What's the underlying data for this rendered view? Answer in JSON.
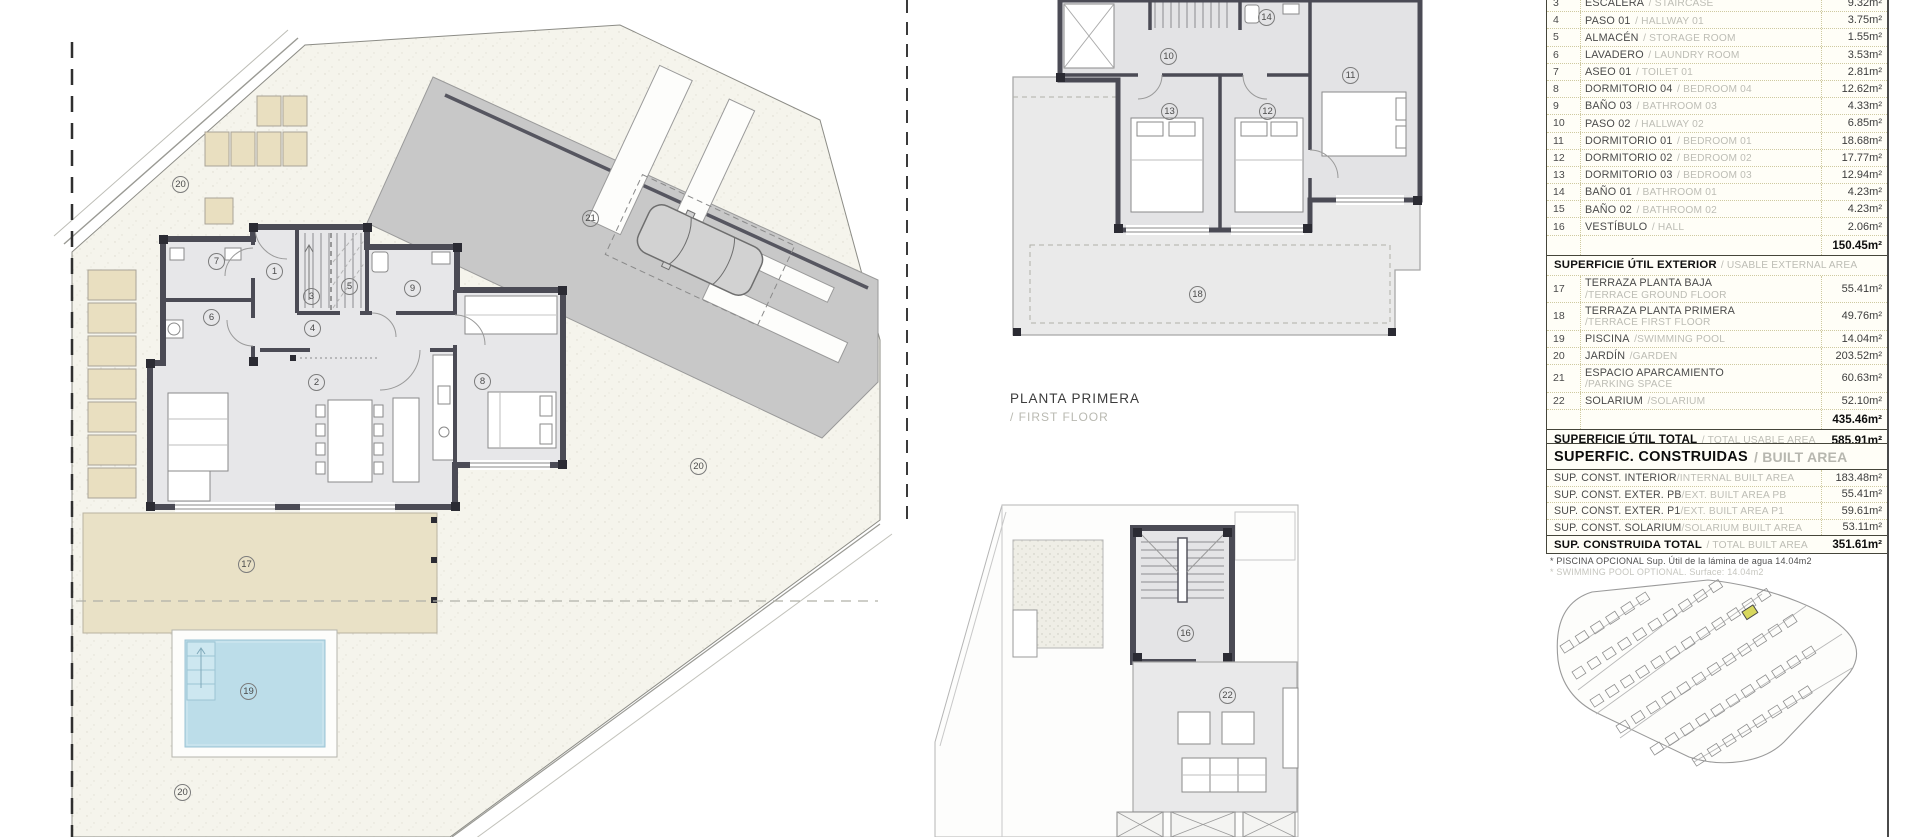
{
  "rooms": {
    "n1": "1",
    "n2": "2",
    "n3": "3",
    "n4": "4",
    "n5": "5",
    "n6": "6",
    "n7": "7",
    "n8": "8",
    "n9": "9",
    "n10": "10",
    "n11": "11",
    "n12": "12",
    "n13": "13",
    "n14": "14",
    "n16": "16",
    "n17": "17",
    "n18": "18",
    "n19": "19",
    "n20": "20",
    "n21": "21",
    "n22": "22"
  },
  "caption": {
    "es": "PLANTA PRIMERA",
    "en": "/ FIRST FLOOR"
  },
  "usable_table": {
    "interior_rows": [
      {
        "num": "3",
        "es": "ESCALERA",
        "en": "/ STAIRCASE",
        "area": "9.32m²"
      },
      {
        "num": "4",
        "es": "PASO 01",
        "en": "/ HALLWAY 01",
        "area": "3.75m²"
      },
      {
        "num": "5",
        "es": "ALMACÉN",
        "en": "/ STORAGE ROOM",
        "area": "1.55m²"
      },
      {
        "num": "6",
        "es": "LAVADERO",
        "en": "/ LAUNDRY ROOM",
        "area": "3.53m²"
      },
      {
        "num": "7",
        "es": "ASEO 01",
        "en": "/ TOILET 01",
        "area": "2.81m²"
      },
      {
        "num": "8",
        "es": "DORMITORIO 04",
        "en": "/ BEDROOM 04",
        "area": "12.62m²"
      },
      {
        "num": "9",
        "es": "BAÑO 03",
        "en": "/ BATHROOM 03",
        "area": "4.33m²"
      },
      {
        "num": "10",
        "es": "PASO 02",
        "en": "/ HALLWAY 02",
        "area": "6.85m²"
      },
      {
        "num": "11",
        "es": "DORMITORIO 01",
        "en": "/ BEDROOM 01",
        "area": "18.68m²"
      },
      {
        "num": "12",
        "es": "DORMITORIO 02",
        "en": "/ BEDROOM 02",
        "area": "17.77m²"
      },
      {
        "num": "13",
        "es": "DORMITORIO 03",
        "en": "/ BEDROOM 03",
        "area": "12.94m²"
      },
      {
        "num": "14",
        "es": "BAÑO 01",
        "en": "/ BATHROOM 01",
        "area": "4.23m²"
      },
      {
        "num": "15",
        "es": "BAÑO 02",
        "en": "/ BATHROOM 02",
        "area": "4.23m²"
      },
      {
        "num": "16",
        "es": "VESTÍBULO",
        "en": "/ HALL",
        "area": "2.06m²"
      }
    ],
    "interior_subtotal": "150.45m²",
    "exterior_header": {
      "es": "SUPERFICIE ÚTIL EXTERIOR",
      "en": "/ USABLE EXTERNAL AREA"
    },
    "exterior_rows": [
      {
        "num": "17",
        "es": "TERRAZA PLANTA BAJA",
        "en": "/TERRACE GROUND FLOOR",
        "area": "55.41m²"
      },
      {
        "num": "18",
        "es": "TERRAZA PLANTA PRIMERA",
        "en": "/TERRACE FIRST FLOOR",
        "area": "49.76m²"
      },
      {
        "num": "19",
        "es": "PISCINA",
        "en": "/SWIMMING POOL",
        "area": "14.04m²"
      },
      {
        "num": "20",
        "es": "JARDÍN",
        "en": "/GARDEN",
        "area": "203.52m²"
      },
      {
        "num": "21",
        "es": "ESPACIO APARCAMIENTO",
        "en": "/PARKING SPACE",
        "area": "60.63m²"
      },
      {
        "num": "22",
        "es": "SOLARIUM",
        "en": "/SOLARIUM",
        "area": "52.10m²"
      }
    ],
    "exterior_subtotal": "435.46m²",
    "total": {
      "es": "SUPERFICIE ÚTIL TOTAL",
      "en": "/ TOTAL USABLE AREA",
      "area": "585.91m²"
    }
  },
  "built_table": {
    "title": {
      "es": "SUPERFIC. CONSTRUIDAS",
      "en": "/ BUILT AREA"
    },
    "rows": [
      {
        "es": "SUP. CONST. INTERIOR",
        "en": "/INTERNAL BUILT AREA",
        "area": "183.48m²"
      },
      {
        "es": "SUP. CONST. EXTER. PB",
        "en": "/EXT. BUILT AREA PB",
        "area": "55.41m²"
      },
      {
        "es": "SUP. CONST. EXTER. P1",
        "en": "/EXT. BUILT AREA P1",
        "area": "59.61m²"
      },
      {
        "es": "SUP. CONST. SOLARIUM",
        "en": "/SOLARIUM BUILT AREA",
        "area": "53.11m²"
      }
    ],
    "total": {
      "es": "SUP. CONSTRUIDA TOTAL",
      "en": "/ TOTAL BUILT AREA",
      "area": "351.61m²"
    }
  },
  "footnotes": {
    "line1": "* PISCINA OPCIONAL Sup. Útil de la lámina de agua 14.04m2",
    "line2": "* SWIMMING POOL OPTIONAL. Surface: 14.04m2"
  },
  "colors": {
    "plot_highlight": "#d8d85e",
    "pool": "#bcdde9",
    "terrace": "#e9e1c6",
    "parking": "#c8c8c8",
    "wall": "#4b4b55",
    "table_grid": "#cfcaa0"
  }
}
